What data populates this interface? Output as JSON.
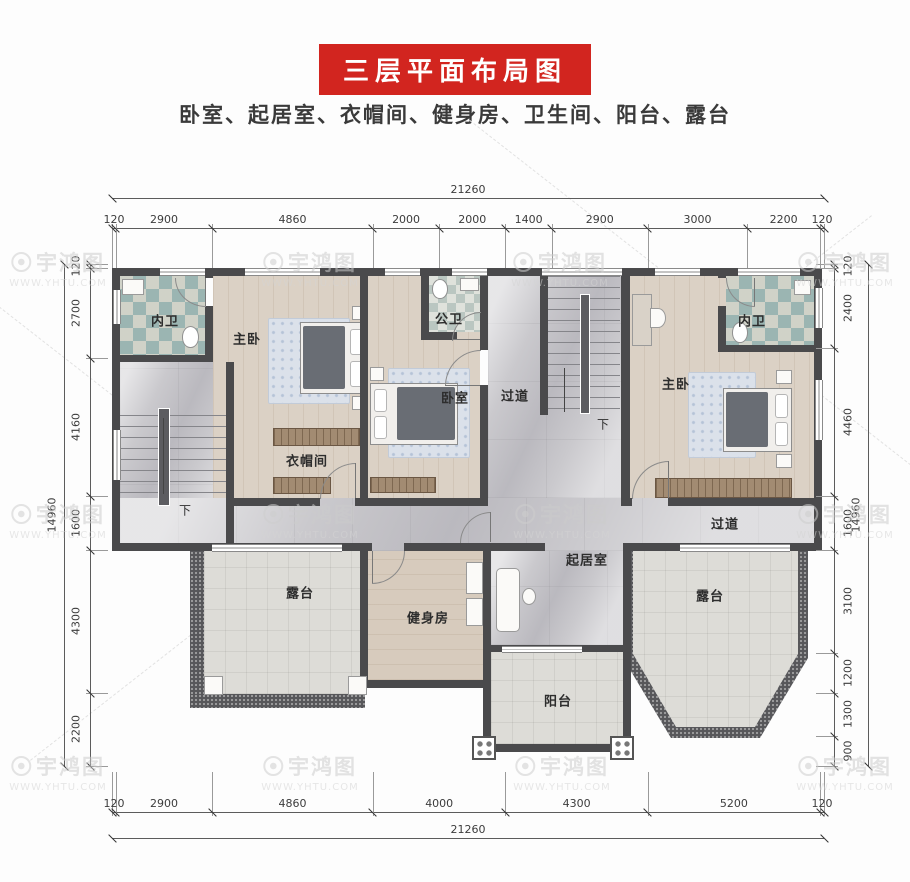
{
  "title": "三层平面布局图",
  "subtitle": "卧室、起居室、衣帽间、健身房、卫生间、阳台、露台",
  "watermark": {
    "brand": "宇鸿图",
    "url": "WWW.YHTU.COM"
  },
  "dimensions": {
    "top": {
      "total": "21260",
      "segments": [
        "120",
        "2900",
        "4860",
        "2000",
        "2000",
        "1400",
        "2900",
        "3000",
        "2200",
        "120"
      ]
    },
    "bottom": {
      "total": "21260",
      "segments": [
        "120",
        "2900",
        "4860",
        "4000",
        "4300",
        "5200",
        "120"
      ]
    },
    "left": {
      "total": "14960",
      "segments": [
        "120",
        "2700",
        "4160",
        "1600",
        "4300",
        "2200"
      ]
    },
    "right": {
      "total": "14960",
      "segments": [
        "120",
        "2400",
        "4460",
        "1600",
        "3100",
        "1200",
        "1300",
        "900"
      ]
    }
  },
  "rooms": {
    "bath_left": "内卫",
    "master_left": "主卧",
    "closet": "衣帽间",
    "public_bath": "公卫",
    "bedroom_mid": "卧室",
    "hallway_vertical": "过道",
    "hallway_right": "过道",
    "master_right": "主卧",
    "bath_right": "内卫",
    "living": "起居室",
    "gym": "健身房",
    "terrace_left": "露台",
    "terrace_right": "露台",
    "balcony": "阳台",
    "stairs_left_down": "下",
    "stairs_center_down": "下"
  }
}
